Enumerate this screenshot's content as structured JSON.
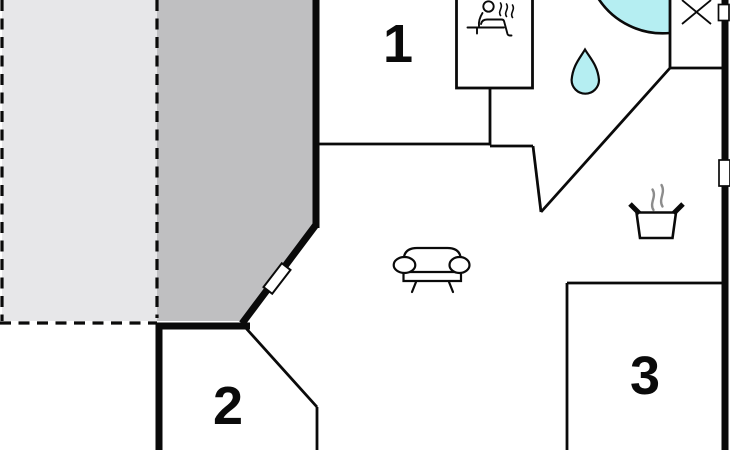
{
  "plan": {
    "kind": "floor-plan",
    "rooms": [
      {
        "id": "room-1",
        "label": "1"
      },
      {
        "id": "room-2",
        "label": "2"
      },
      {
        "id": "room-3",
        "label": "3"
      }
    ],
    "areas": [
      {
        "name": "open-terrace"
      },
      {
        "name": "covered-terrace"
      }
    ],
    "icons": [
      "sauna-icon",
      "water-drop-icon",
      "shower-basin-icon",
      "window-cross-icon",
      "sofa-icon",
      "cooking-pot-icon",
      "door-icon",
      "window-icon"
    ]
  },
  "colors": {
    "wall": "#0a0a0a",
    "water": "#b5eef2",
    "terrace_light": "#e7e7e9",
    "terrace_dark": "#bfbfc1",
    "steam": "#8c8c8c",
    "background": "#ffffff"
  }
}
